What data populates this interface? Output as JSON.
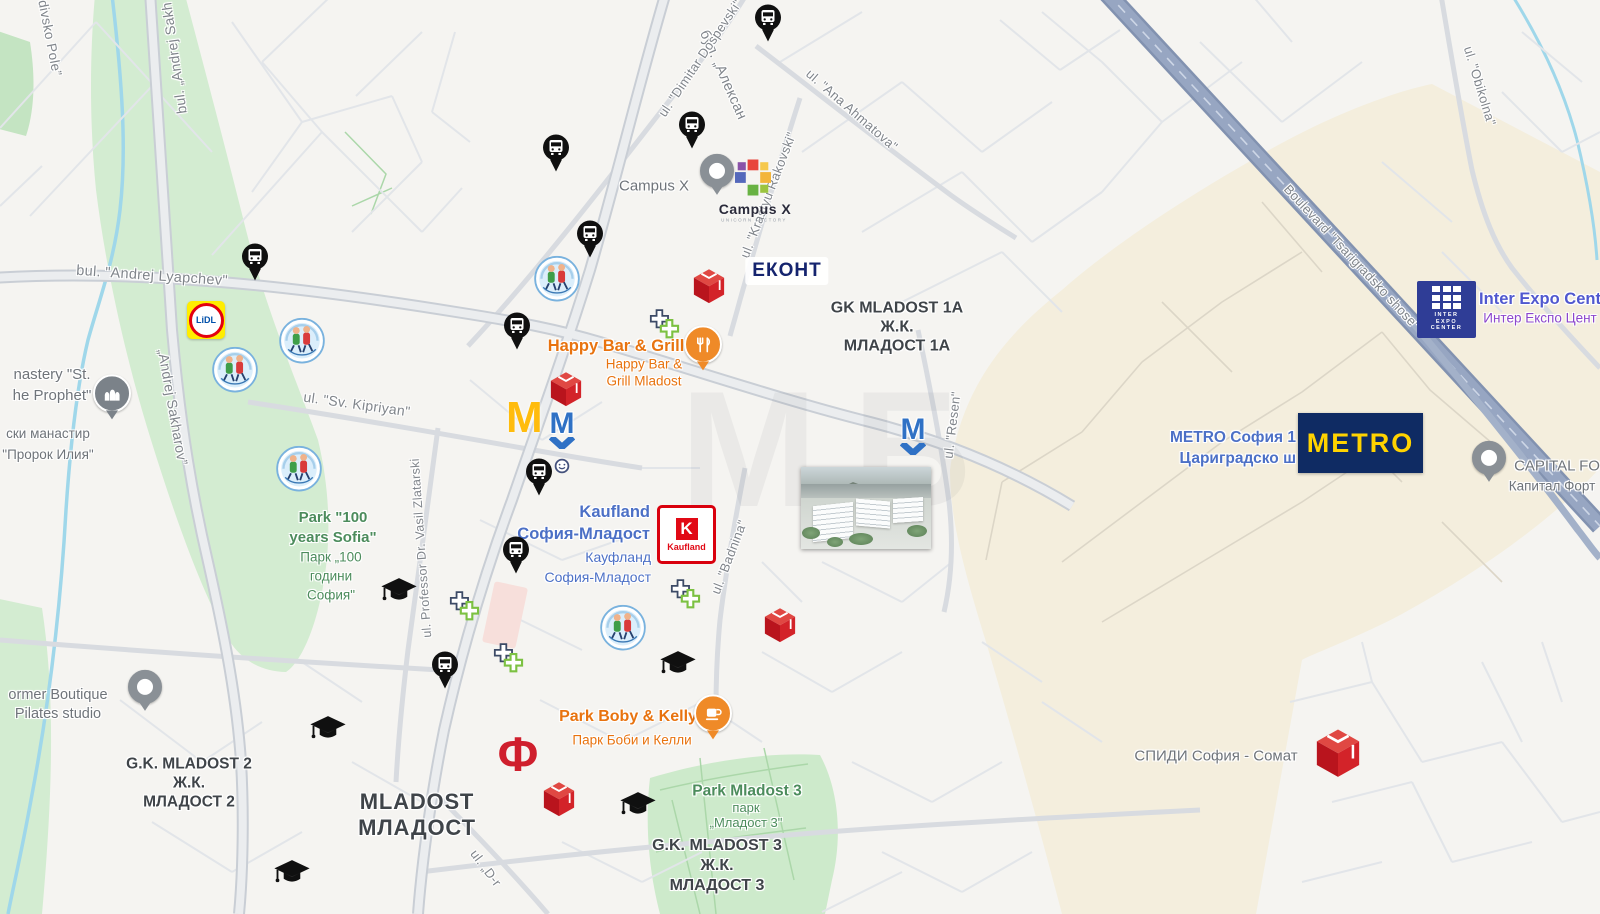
{
  "colors": {
    "land": "#f5f4f1",
    "district_beige": "#f4eedd",
    "park_green": "#d3ecd1",
    "water": "#9fd7ea",
    "road_minor": "#e2e5e9",
    "road_medium": "#d8dbe0",
    "road_major_fill": "#ebedef",
    "road_major_casing": "#c9ced5",
    "highway": "#97a6c2",
    "accent_orange": "#e8730f",
    "accent_blue": "#4c70c6",
    "accent_green": "#4c8c5c",
    "label_dark": "#3f4449",
    "label_gray": "#80858b"
  },
  "watermark": {
    "text": "МБ"
  },
  "street_labels": [
    {
      "id": "divsko-pole",
      "text": "divsko Pole”",
      "x": 50,
      "y": 38,
      "rot": 79,
      "size": 13.5
    },
    {
      "id": "sakharov-top",
      "text": "bul. „Andrej Sakh",
      "x": 174,
      "y": 58,
      "rot": -98,
      "size": 14
    },
    {
      "id": "sakharov-mid",
      "text": "„Andrej Sakharov”",
      "x": 173,
      "y": 407,
      "rot": 80,
      "size": 14
    },
    {
      "id": "lyapchev",
      "text": "bul. \"Andrej Lyapchev\"",
      "x": 152,
      "y": 276,
      "rot": 4,
      "size": 14.5
    },
    {
      "id": "malinov",
      "text": "бул. „Алексан",
      "x": 723,
      "y": 75,
      "rot": 66,
      "size": 14.5
    },
    {
      "id": "dospevski",
      "text": "ul. \"Dimitar Dospevski\"",
      "x": 700,
      "y": 58,
      "rot": -56,
      "size": 13
    },
    {
      "id": "ahmatova",
      "text": "ul. \"Ana Ahmatova\"",
      "x": 852,
      "y": 110,
      "rot": 41,
      "size": 13
    },
    {
      "id": "rakovski",
      "text": "ul. \"Krastyu Rakovski\"",
      "x": 768,
      "y": 195,
      "rot": -69,
      "size": 13
    },
    {
      "id": "resen",
      "text": "ul. \"Resen\"",
      "x": 952,
      "y": 425,
      "rot": -83,
      "size": 13
    },
    {
      "id": "badnina",
      "text": "ul. \"Badnina\"",
      "x": 729,
      "y": 557,
      "rot": -69,
      "size": 13
    },
    {
      "id": "kipriyan",
      "text": "ul. \"Sv. Kipriyan\"",
      "x": 357,
      "y": 404,
      "rot": 8,
      "size": 14
    },
    {
      "id": "zlatarski",
      "text": "ul. Professor Dr. Vasil Zlatarski",
      "x": 421,
      "y": 548,
      "rot": -94,
      "size": 12.5
    },
    {
      "id": "obikolna",
      "text": "ul. \"Obikolna\"",
      "x": 1480,
      "y": 86,
      "rot": 73,
      "size": 13
    },
    {
      "id": "tsarigradsko",
      "text": "Boulevard \"Tsarigradsko shose\"",
      "x": 1352,
      "y": 257,
      "rot": 47,
      "size": 13
    },
    {
      "id": "d-r",
      "text": "ul. „D-r",
      "x": 486,
      "y": 868,
      "rot": 53,
      "size": 13
    }
  ],
  "area_labels": [
    {
      "id": "gk-mladost-1a",
      "lines": [
        "GK MLADOST 1A",
        "Ж.К.",
        "МЛАДОСТ 1А"
      ],
      "x": 897,
      "y": 327,
      "size": 16,
      "lh": 19,
      "cls": "",
      "ia": false
    },
    {
      "id": "gk-mladost-2",
      "lines": [
        "G.K. MLADOST 2",
        "Ж.К.",
        "МЛАДОСТ 2"
      ],
      "x": 189,
      "y": 783,
      "size": 15.5,
      "lh": 19,
      "cls": "",
      "ia": false
    },
    {
      "id": "gk-mladost-3",
      "lines": [
        "G.K. MLADOST 3",
        "Ж.К.",
        "МЛАДОСТ 3"
      ],
      "x": 717,
      "y": 866,
      "size": 16,
      "lh": 20,
      "cls": "",
      "ia": false
    },
    {
      "id": "mladost-big",
      "lines": [
        "MLADOST",
        "МЛАДОСТ"
      ],
      "x": 417,
      "y": 815,
      "size": 22,
      "lh": 26,
      "cls": "ls",
      "ia": false
    },
    {
      "id": "park-100-en",
      "lines": [
        "Park \"100",
        "years Sofia\""
      ],
      "x": 333,
      "y": 528,
      "size": 15,
      "lh": 20,
      "cls": "green",
      "ia": true
    },
    {
      "id": "park-100-bg",
      "lines": [
        "Парк „100",
        "години",
        "София\""
      ],
      "x": 331,
      "y": 576,
      "size": 13.5,
      "lh": 19,
      "cls": "green sub",
      "ia": true
    },
    {
      "id": "park-mladost3-en",
      "lines": [
        "Park Mladost 3"
      ],
      "x": 747,
      "y": 791,
      "size": 15.5,
      "lh": 17,
      "cls": "green",
      "ia": true
    },
    {
      "id": "park-mladost3-bg",
      "lines": [
        "парк",
        "„Младост 3\""
      ],
      "x": 746,
      "y": 815,
      "size": 13,
      "lh": 15,
      "cls": "green sub",
      "ia": true
    },
    {
      "id": "monastery-en",
      "lines": [
        "nastery \"St.",
        "he Prophet\""
      ],
      "x": 52,
      "y": 385,
      "size": 15,
      "lh": 21,
      "cls": "gray sub",
      "ia": true
    },
    {
      "id": "monastery-bg",
      "lines": [
        "ски манастир",
        "\"Пророк Илия\""
      ],
      "x": 48,
      "y": 444,
      "size": 13.5,
      "lh": 21,
      "cls": "gray sub",
      "ia": true
    },
    {
      "id": "former-boutique",
      "lines": [
        "ormer Boutique",
        "Pilates studio"
      ],
      "x": 58,
      "y": 705,
      "size": 14.5,
      "lh": 19,
      "cls": "gray sub",
      "ia": true
    },
    {
      "id": "spidi",
      "lines": [
        "СПИДИ София - Сомат"
      ],
      "x": 1216,
      "y": 756,
      "size": 15,
      "lh": 17,
      "cls": "gray sub",
      "ia": true
    },
    {
      "id": "capital-fort-en",
      "lines": [
        "CAPITAL FO"
      ],
      "x": 1557,
      "y": 466,
      "size": 15,
      "lh": 17,
      "cls": "gray sub",
      "ia": true
    },
    {
      "id": "capital-fort-bg",
      "lines": [
        "Капитал Форт"
      ],
      "x": 1552,
      "y": 486,
      "size": 13.5,
      "lh": 15,
      "cls": "gray sub",
      "ia": true
    },
    {
      "id": "inter-expo-en",
      "lines": [
        "Inter Expo Cent"
      ],
      "x": 1540,
      "y": 299,
      "size": 16.5,
      "lh": 18,
      "cls": "indigo",
      "ia": true
    },
    {
      "id": "inter-expo-bg",
      "lines": [
        "Интер Експо Цент"
      ],
      "x": 1540,
      "y": 318,
      "size": 13.5,
      "lh": 15,
      "cls": "purple sub",
      "ia": true
    },
    {
      "id": "metro-sofia",
      "lines": [
        "METRO София 1",
        "Цариградско ш"
      ],
      "x": 1296,
      "y": 448,
      "size": 15.5,
      "lh": 21,
      "cls": "blue",
      "align": "right",
      "ia": true
    },
    {
      "id": "kaufland-en",
      "lines": [
        "Kaufland",
        "София-Младост"
      ],
      "x": 650,
      "y": 523,
      "size": 16.5,
      "lh": 22,
      "cls": "blue",
      "align": "right",
      "ia": true
    },
    {
      "id": "kaufland-bg",
      "lines": [
        "Кауфланд",
        "София-Младост"
      ],
      "x": 651,
      "y": 567,
      "size": 14,
      "lh": 20,
      "cls": "blue sub",
      "align": "right",
      "ia": true
    },
    {
      "id": "happy-en",
      "lines": [
        "Happy Bar & Grill"
      ],
      "x": 616,
      "y": 346,
      "size": 16.5,
      "lh": 18,
      "cls": "orange",
      "ia": true
    },
    {
      "id": "happy-bg",
      "lines": [
        "Happy Bar &",
        "Grill Mladost"
      ],
      "x": 644,
      "y": 373,
      "size": 13.5,
      "lh": 16.5,
      "cls": "orange sub",
      "ia": true
    },
    {
      "id": "boby-en",
      "lines": [
        "Park Boby & Kelly"
      ],
      "x": 628,
      "y": 717,
      "size": 16,
      "lh": 18,
      "cls": "orange",
      "ia": true
    },
    {
      "id": "boby-bg",
      "lines": [
        "Парк Боби и Келли"
      ],
      "x": 632,
      "y": 740,
      "size": 13.5,
      "lh": 15,
      "cls": "orange sub",
      "ia": true
    },
    {
      "id": "campus-x-map",
      "lines": [
        "Campus X"
      ],
      "x": 654,
      "y": 186,
      "size": 15,
      "lh": 17,
      "cls": "gray sub",
      "ia": true
    }
  ],
  "logos": {
    "lidl": {
      "text": "LiDL"
    },
    "mcdonalds": {
      "glyph": "M"
    },
    "metro_subway": {
      "glyph": "М"
    },
    "econt": {
      "text": "ЕКОНТ"
    },
    "kaufland": {
      "k": "K",
      "text": "Kaufland"
    },
    "metro_store": {
      "text": "METRO"
    },
    "inter_expo": {
      "l1": "INTER",
      "l2": "EXPO",
      "l3": "CENTER"
    },
    "campus_x": {
      "title": "Campus X",
      "tagline": "UNICORN FACTORY"
    },
    "fantastico": {
      "glyph": "Ф"
    }
  },
  "markers": {
    "bus-stop": [
      [
        768,
        25
      ],
      [
        692,
        132
      ],
      [
        556,
        155
      ],
      [
        590,
        241
      ],
      [
        255,
        264
      ],
      [
        517,
        333
      ],
      [
        539,
        479
      ],
      [
        516,
        557
      ],
      [
        445,
        672
      ]
    ],
    "graduation-cap": [
      [
        399,
        592
      ],
      [
        678,
        665
      ],
      [
        328,
        730
      ],
      [
        638,
        806
      ],
      [
        292,
        874
      ]
    ],
    "kindergarten": [
      [
        235,
        372
      ],
      [
        302,
        343
      ],
      [
        299,
        471
      ],
      [
        557,
        281
      ],
      [
        623,
        630
      ]
    ],
    "pharmacy": [
      [
        666,
        327
      ],
      [
        466,
        609
      ],
      [
        510,
        661
      ],
      [
        687,
        597
      ]
    ],
    "parcel-cube": [
      [
        709,
        288
      ],
      [
        566,
        391
      ],
      [
        780,
        627
      ],
      [
        559,
        801
      ],
      [
        1338,
        755,
        1.4
      ]
    ],
    "metro-logo": [
      [
        562,
        430
      ],
      [
        913,
        436
      ]
    ]
  }
}
